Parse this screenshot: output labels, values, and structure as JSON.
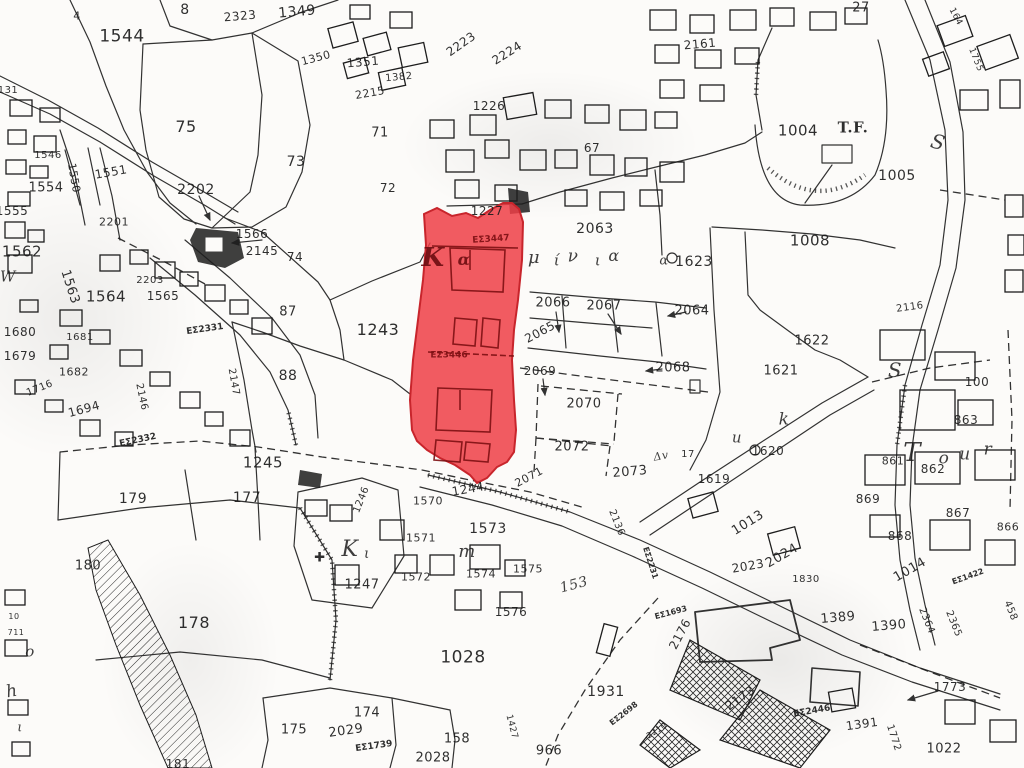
{
  "map": {
    "type": "cadastral-survey-plan",
    "colors": {
      "paper": "#fcfbf9",
      "ink": "#1d1d1d",
      "highlight_fill": "#ee3e46",
      "highlight_outline": "#c8252c",
      "highlight_building_ink": "#7e1013"
    },
    "highlighted_parcels": [
      "EΣ3447",
      "EΣ3446"
    ],
    "place_names": [
      "Καμίνια",
      "Tour",
      "T.F."
    ],
    "labels": [
      {
        "t": "8",
        "x": 185,
        "y": 10,
        "s": 14
      },
      {
        "t": "2323",
        "x": 240,
        "y": 16,
        "s": 12,
        "r": -5
      },
      {
        "t": "1349",
        "x": 297,
        "y": 12,
        "s": 14,
        "r": -5
      },
      {
        "t": "4",
        "x": 77,
        "y": 16,
        "s": 11
      },
      {
        "t": "1544",
        "x": 122,
        "y": 37,
        "s": 17
      },
      {
        "t": "1350",
        "x": 316,
        "y": 58,
        "s": 11,
        "r": -15
      },
      {
        "t": "1351",
        "x": 363,
        "y": 62,
        "s": 12,
        "r": -5
      },
      {
        "t": "1382",
        "x": 399,
        "y": 78,
        "s": 10,
        "r": -5
      },
      {
        "t": "2215",
        "x": 370,
        "y": 93,
        "s": 11,
        "r": -10
      },
      {
        "t": "2223",
        "x": 461,
        "y": 44,
        "s": 12,
        "r": -35
      },
      {
        "t": "2224",
        "x": 507,
        "y": 53,
        "s": 12,
        "r": -32
      },
      {
        "t": "1226",
        "x": 489,
        "y": 106,
        "s": 12
      },
      {
        "t": "2161",
        "x": 700,
        "y": 44,
        "s": 12,
        "r": -5
      },
      {
        "t": "27",
        "x": 861,
        "y": 8,
        "s": 13
      },
      {
        "t": "164",
        "x": 955,
        "y": 17,
        "s": 9,
        "r": 62
      },
      {
        "t": "1755",
        "x": 975,
        "y": 60,
        "s": 9,
        "r": 68
      },
      {
        "t": "75",
        "x": 186,
        "y": 127,
        "s": 16
      },
      {
        "t": "73",
        "x": 296,
        "y": 162,
        "s": 14
      },
      {
        "t": "71",
        "x": 380,
        "y": 133,
        "s": 13
      },
      {
        "t": "72",
        "x": 388,
        "y": 188,
        "s": 12
      },
      {
        "t": "67",
        "x": 592,
        "y": 148,
        "s": 12
      },
      {
        "t": "1004",
        "x": 798,
        "y": 131,
        "s": 15
      },
      {
        "t": "T.F.",
        "x": 853,
        "y": 128,
        "s": 15,
        "k": "serifcap"
      },
      {
        "t": "1005",
        "x": 897,
        "y": 176,
        "s": 14
      },
      {
        "t": "1008",
        "x": 810,
        "y": 241,
        "s": 15
      },
      {
        "t": "1227",
        "x": 487,
        "y": 211,
        "s": 12
      },
      {
        "t": "131",
        "x": 8,
        "y": 91,
        "s": 10
      },
      {
        "t": "1546",
        "x": 48,
        "y": 156,
        "s": 10
      },
      {
        "t": "1551",
        "x": 111,
        "y": 172,
        "s": 12,
        "r": -10
      },
      {
        "t": "1550",
        "x": 74,
        "y": 178,
        "s": 11,
        "r": 80
      },
      {
        "t": "1554",
        "x": 46,
        "y": 188,
        "s": 13
      },
      {
        "t": "1555",
        "x": 12,
        "y": 211,
        "s": 12
      },
      {
        "t": "2201",
        "x": 114,
        "y": 222,
        "s": 11
      },
      {
        "t": "2202",
        "x": 196,
        "y": 190,
        "s": 14
      },
      {
        "t": "1562",
        "x": 22,
        "y": 252,
        "s": 15
      },
      {
        "t": "1563",
        "x": 70,
        "y": 287,
        "s": 13,
        "r": 72
      },
      {
        "t": "1564",
        "x": 106,
        "y": 297,
        "s": 15
      },
      {
        "t": "2203",
        "x": 150,
        "y": 281,
        "s": 10
      },
      {
        "t": "1565",
        "x": 163,
        "y": 296,
        "s": 12
      },
      {
        "t": "1566",
        "x": 252,
        "y": 234,
        "s": 12
      },
      {
        "t": "2145",
        "x": 262,
        "y": 251,
        "s": 12
      },
      {
        "t": "74",
        "x": 295,
        "y": 257,
        "s": 12
      },
      {
        "t": "87",
        "x": 288,
        "y": 312,
        "s": 13
      },
      {
        "t": "1243",
        "x": 378,
        "y": 330,
        "s": 16
      },
      {
        "t": "88",
        "x": 288,
        "y": 376,
        "s": 14
      },
      {
        "t": "EΣ2331",
        "x": 205,
        "y": 330,
        "s": 9,
        "r": -8,
        "k": "es"
      },
      {
        "t": "1680",
        "x": 20,
        "y": 332,
        "s": 12
      },
      {
        "t": "1681",
        "x": 80,
        "y": 338,
        "s": 10
      },
      {
        "t": "1679",
        "x": 20,
        "y": 356,
        "s": 12
      },
      {
        "t": "1682",
        "x": 74,
        "y": 372,
        "s": 11
      },
      {
        "t": "1716",
        "x": 40,
        "y": 389,
        "s": 10,
        "r": -22
      },
      {
        "t": "1694",
        "x": 84,
        "y": 409,
        "s": 12,
        "r": -15
      },
      {
        "t": "2146",
        "x": 141,
        "y": 397,
        "s": 10,
        "r": 78
      },
      {
        "t": "2147",
        "x": 233,
        "y": 382,
        "s": 10,
        "r": 80
      },
      {
        "t": "2063",
        "x": 595,
        "y": 229,
        "s": 14
      },
      {
        "t": "2066",
        "x": 553,
        "y": 303,
        "s": 13
      },
      {
        "t": "2067",
        "x": 604,
        "y": 306,
        "s": 13
      },
      {
        "t": "2064",
        "x": 692,
        "y": 311,
        "s": 13
      },
      {
        "t": "2065",
        "x": 540,
        "y": 332,
        "s": 12,
        "r": -28
      },
      {
        "t": "2068",
        "x": 673,
        "y": 368,
        "s": 13
      },
      {
        "t": "2069",
        "x": 540,
        "y": 371,
        "s": 12
      },
      {
        "t": "2070",
        "x": 584,
        "y": 404,
        "s": 13
      },
      {
        "t": "2072",
        "x": 572,
        "y": 447,
        "s": 13
      },
      {
        "t": "2071",
        "x": 529,
        "y": 477,
        "s": 11,
        "r": -28
      },
      {
        "t": "2073",
        "x": 630,
        "y": 472,
        "s": 13,
        "r": -5
      },
      {
        "t": "1623",
        "x": 694,
        "y": 262,
        "s": 14
      },
      {
        "t": "1622",
        "x": 812,
        "y": 341,
        "s": 13
      },
      {
        "t": "1621",
        "x": 781,
        "y": 371,
        "s": 13
      },
      {
        "t": "1620",
        "x": 768,
        "y": 451,
        "s": 12
      },
      {
        "t": "1619",
        "x": 714,
        "y": 479,
        "s": 12
      },
      {
        "t": "Δv",
        "x": 661,
        "y": 456,
        "s": 11,
        "r": -10,
        "k": "cur"
      },
      {
        "t": "17",
        "x": 688,
        "y": 455,
        "s": 10
      },
      {
        "t": "2136",
        "x": 616,
        "y": 523,
        "s": 10,
        "r": 68
      },
      {
        "t": "2116",
        "x": 910,
        "y": 308,
        "s": 10,
        "r": -8
      },
      {
        "t": "100",
        "x": 977,
        "y": 382,
        "s": 12
      },
      {
        "t": "863",
        "x": 966,
        "y": 420,
        "s": 12
      },
      {
        "t": "861",
        "x": 893,
        "y": 461,
        "s": 11
      },
      {
        "t": "862",
        "x": 933,
        "y": 469,
        "s": 12
      },
      {
        "t": "869",
        "x": 868,
        "y": 499,
        "s": 12
      },
      {
        "t": "867",
        "x": 958,
        "y": 513,
        "s": 12
      },
      {
        "t": "868",
        "x": 900,
        "y": 536,
        "s": 12
      },
      {
        "t": "866",
        "x": 1008,
        "y": 527,
        "s": 11
      },
      {
        "t": "1013",
        "x": 748,
        "y": 523,
        "s": 13,
        "r": -32
      },
      {
        "t": "2024",
        "x": 782,
        "y": 556,
        "s": 13,
        "r": -30
      },
      {
        "t": "2023",
        "x": 748,
        "y": 566,
        "s": 12,
        "r": -10
      },
      {
        "t": "1830",
        "x": 806,
        "y": 580,
        "s": 10
      },
      {
        "t": "1014",
        "x": 910,
        "y": 570,
        "s": 13,
        "r": -30
      },
      {
        "t": "EΣ1422",
        "x": 968,
        "y": 577,
        "s": 8,
        "r": -20,
        "k": "es"
      },
      {
        "t": "1389",
        "x": 838,
        "y": 618,
        "s": 13,
        "r": -5
      },
      {
        "t": "1390",
        "x": 889,
        "y": 626,
        "s": 13,
        "r": -5
      },
      {
        "t": "2364",
        "x": 926,
        "y": 621,
        "s": 10,
        "r": 68
      },
      {
        "t": "2365",
        "x": 953,
        "y": 624,
        "s": 10,
        "r": 68
      },
      {
        "t": "458",
        "x": 1010,
        "y": 611,
        "s": 10,
        "r": 68
      },
      {
        "t": "EΣ2231",
        "x": 650,
        "y": 563,
        "s": 8,
        "r": 72,
        "k": "es"
      },
      {
        "t": "EΣ1693",
        "x": 671,
        "y": 613,
        "s": 8,
        "r": -15,
        "k": "es"
      },
      {
        "t": "2176",
        "x": 680,
        "y": 634,
        "s": 12,
        "r": -62
      },
      {
        "t": "1931",
        "x": 606,
        "y": 692,
        "s": 14
      },
      {
        "t": "EΣ2698",
        "x": 624,
        "y": 714,
        "s": 8,
        "r": -38,
        "k": "es"
      },
      {
        "t": "2210",
        "x": 657,
        "y": 731,
        "s": 8,
        "r": -32
      },
      {
        "t": "2173",
        "x": 740,
        "y": 698,
        "s": 12,
        "r": -35
      },
      {
        "t": "EΣ2446",
        "x": 812,
        "y": 712,
        "s": 9,
        "r": -10,
        "k": "es"
      },
      {
        "t": "1391",
        "x": 862,
        "y": 724,
        "s": 12,
        "r": -8
      },
      {
        "t": "1772",
        "x": 893,
        "y": 738,
        "s": 10,
        "r": 72
      },
      {
        "t": "1773",
        "x": 950,
        "y": 687,
        "s": 12
      },
      {
        "t": "1022",
        "x": 944,
        "y": 749,
        "s": 13
      },
      {
        "t": "1028",
        "x": 463,
        "y": 658,
        "s": 17
      },
      {
        "t": "1576",
        "x": 511,
        "y": 612,
        "s": 12
      },
      {
        "t": "966",
        "x": 549,
        "y": 751,
        "s": 13
      },
      {
        "t": "158",
        "x": 457,
        "y": 739,
        "s": 13
      },
      {
        "t": "2028",
        "x": 433,
        "y": 758,
        "s": 13
      },
      {
        "t": "1427",
        "x": 511,
        "y": 727,
        "s": 9,
        "r": 75
      },
      {
        "t": "174",
        "x": 367,
        "y": 713,
        "s": 13
      },
      {
        "t": "2029",
        "x": 346,
        "y": 731,
        "s": 13,
        "r": -8
      },
      {
        "t": "EΣ1739",
        "x": 374,
        "y": 747,
        "s": 9,
        "r": -8,
        "k": "es"
      },
      {
        "t": "175",
        "x": 294,
        "y": 730,
        "s": 13
      },
      {
        "t": "178",
        "x": 194,
        "y": 623,
        "s": 16
      },
      {
        "t": "180",
        "x": 88,
        "y": 566,
        "s": 13
      },
      {
        "t": "181",
        "x": 178,
        "y": 764,
        "s": 12
      },
      {
        "t": "179",
        "x": 133,
        "y": 499,
        "s": 14
      },
      {
        "t": "177",
        "x": 247,
        "y": 498,
        "s": 14
      },
      {
        "t": "1245",
        "x": 263,
        "y": 463,
        "s": 15
      },
      {
        "t": "1244",
        "x": 468,
        "y": 489,
        "s": 12,
        "r": -10
      },
      {
        "t": "EΣ2332",
        "x": 138,
        "y": 441,
        "s": 9,
        "r": -12,
        "k": "es"
      },
      {
        "t": "1570",
        "x": 428,
        "y": 501,
        "s": 11
      },
      {
        "t": "1571",
        "x": 421,
        "y": 538,
        "s": 11
      },
      {
        "t": "1572",
        "x": 416,
        "y": 577,
        "s": 11
      },
      {
        "t": "1573",
        "x": 488,
        "y": 529,
        "s": 14
      },
      {
        "t": "1574",
        "x": 481,
        "y": 574,
        "s": 11
      },
      {
        "t": "1575",
        "x": 528,
        "y": 569,
        "s": 11
      },
      {
        "t": "1247",
        "x": 362,
        "y": 585,
        "s": 13
      },
      {
        "t": "1246",
        "x": 362,
        "y": 500,
        "s": 10,
        "r": -68
      },
      {
        "t": "10",
        "x": 14,
        "y": 617,
        "s": 8
      },
      {
        "t": "711",
        "x": 16,
        "y": 633,
        "s": 8
      },
      {
        "t": "EΣ3447",
        "x": 491,
        "y": 240,
        "s": 9,
        "r": -4,
        "k": "red"
      },
      {
        "t": "EΣ3446",
        "x": 449,
        "y": 356,
        "s": 9,
        "k": "red"
      },
      {
        "t": "Κ",
        "x": 433,
        "y": 258,
        "s": 26,
        "k": "redcur"
      },
      {
        "t": "α",
        "x": 464,
        "y": 260,
        "s": 16,
        "k": "redcur"
      },
      {
        "t": "μ",
        "x": 534,
        "y": 258,
        "s": 18,
        "k": "cur"
      },
      {
        "t": "ί",
        "x": 557,
        "y": 261,
        "s": 15,
        "k": "cur"
      },
      {
        "t": "ν",
        "x": 573,
        "y": 257,
        "s": 17,
        "k": "cur"
      },
      {
        "t": "ι",
        "x": 598,
        "y": 261,
        "s": 15,
        "k": "cur"
      },
      {
        "t": "α",
        "x": 614,
        "y": 256,
        "s": 16,
        "k": "cur"
      },
      {
        "t": "α",
        "x": 664,
        "y": 261,
        "s": 13,
        "k": "cur"
      },
      {
        "t": "k",
        "x": 784,
        "y": 420,
        "s": 17,
        "k": "cur"
      },
      {
        "t": "u",
        "x": 737,
        "y": 438,
        "s": 15,
        "k": "cur"
      },
      {
        "t": "T",
        "x": 912,
        "y": 453,
        "s": 26,
        "k": "cur"
      },
      {
        "t": "o",
        "x": 944,
        "y": 459,
        "s": 17,
        "k": "cur"
      },
      {
        "t": "u",
        "x": 965,
        "y": 455,
        "s": 17,
        "k": "cur"
      },
      {
        "t": "r",
        "x": 988,
        "y": 450,
        "s": 17,
        "k": "cur"
      },
      {
        "t": "S",
        "x": 938,
        "y": 142,
        "s": 20,
        "r": 15,
        "k": "cur"
      },
      {
        "t": "S",
        "x": 895,
        "y": 370,
        "s": 20,
        "k": "cur"
      },
      {
        "t": "✚",
        "x": 320,
        "y": 558,
        "s": 13
      },
      {
        "t": "Κ",
        "x": 350,
        "y": 550,
        "s": 22,
        "k": "cur"
      },
      {
        "t": "ι",
        "x": 367,
        "y": 554,
        "s": 14,
        "k": "cur"
      },
      {
        "t": "m",
        "x": 467,
        "y": 552,
        "s": 18,
        "k": "cur"
      },
      {
        "t": "153",
        "x": 574,
        "y": 585,
        "s": 14,
        "r": -15,
        "k": "cur"
      },
      {
        "t": "W",
        "x": 8,
        "y": 277,
        "s": 15,
        "k": "cur"
      },
      {
        "t": "h",
        "x": 12,
        "y": 692,
        "s": 17,
        "r": -10,
        "k": "cur"
      },
      {
        "t": "o",
        "x": 30,
        "y": 652,
        "s": 15,
        "k": "cur"
      },
      {
        "t": "ι",
        "x": 20,
        "y": 728,
        "s": 13,
        "k": "cur"
      }
    ]
  }
}
